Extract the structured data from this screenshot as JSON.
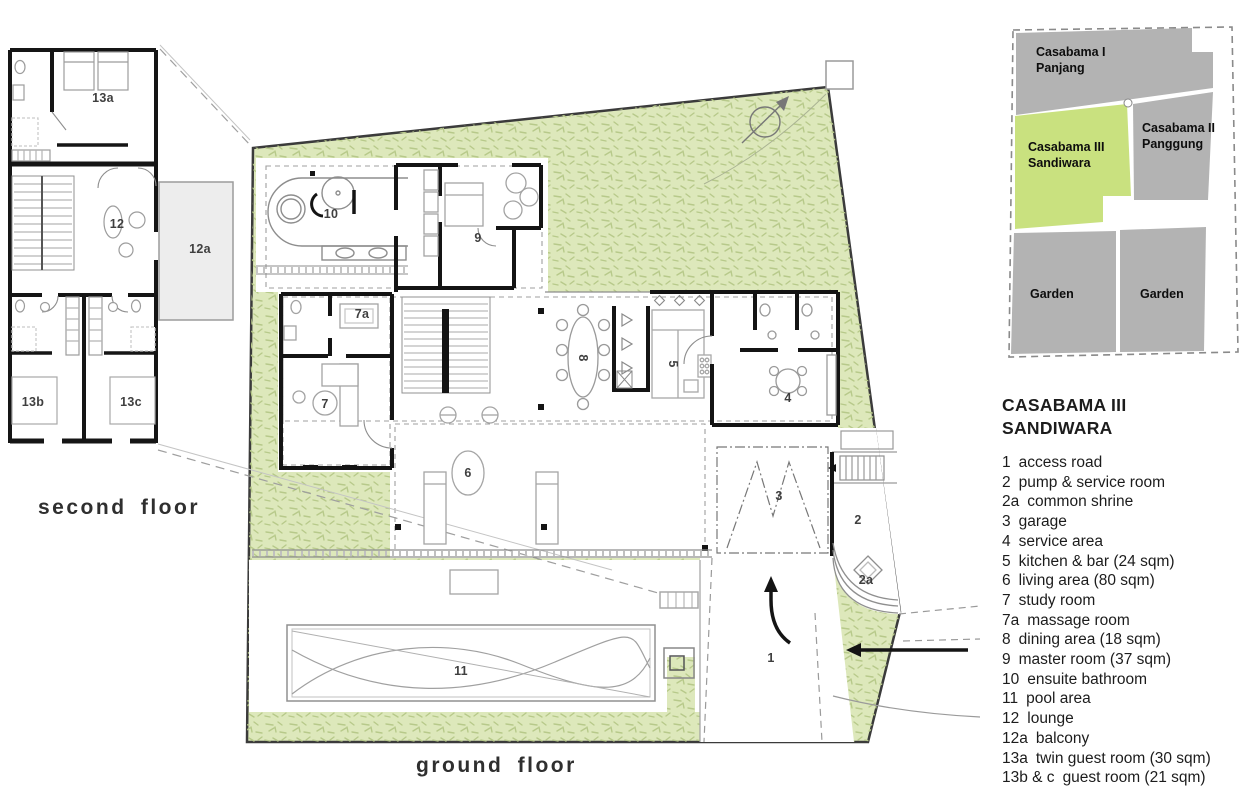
{
  "ground_floor": {
    "caption": "ground floor",
    "room_labels": [
      {
        "key": "10"
      },
      {
        "key": "9"
      },
      {
        "key": "7a"
      },
      {
        "key": "7"
      },
      {
        "key": "8"
      },
      {
        "key": "5"
      },
      {
        "key": "4"
      },
      {
        "key": "6"
      },
      {
        "key": "3"
      },
      {
        "key": "2"
      },
      {
        "key": "2a"
      },
      {
        "key": "1"
      },
      {
        "key": "11"
      }
    ]
  },
  "second_floor": {
    "caption": "second floor",
    "room_labels": [
      {
        "key": "13a"
      },
      {
        "key": "12"
      },
      {
        "key": "12a"
      },
      {
        "key": "13b"
      },
      {
        "key": "13c"
      }
    ]
  },
  "site_map": {
    "blocks": [
      {
        "name": "casabama-1",
        "line1": "Casabama I",
        "line2": "Panjang"
      },
      {
        "name": "casabama-3",
        "line1": "Casabama III",
        "line2": "Sandiwara",
        "highlight": true
      },
      {
        "name": "casabama-2",
        "line1": "Casabama II",
        "line2": "Panggung"
      },
      {
        "name": "garden-left",
        "line1": "Garden"
      },
      {
        "name": "garden-right",
        "line1": "Garden"
      }
    ]
  },
  "legend": {
    "title_line1": "CASABAMA III",
    "title_line2": "SANDIWARA",
    "items": [
      {
        "key": "1",
        "label": "access road"
      },
      {
        "key": "2",
        "label": "pump & service room"
      },
      {
        "key": "2a",
        "label": "common shrine"
      },
      {
        "key": "3",
        "label": "garage"
      },
      {
        "key": "4",
        "label": "service area"
      },
      {
        "key": "5",
        "label": "kitchen & bar (24 sqm)"
      },
      {
        "key": "6",
        "label": "living area (80 sqm)"
      },
      {
        "key": "7",
        "label": "study room"
      },
      {
        "key": "7a",
        "label": "massage room"
      },
      {
        "key": "8",
        "label": "dining area (18 sqm)"
      },
      {
        "key": "9",
        "label": "master room (37 sqm)"
      },
      {
        "key": "10",
        "label": "ensuite bathroom"
      },
      {
        "key": "11",
        "label": "pool area"
      },
      {
        "key": "12",
        "label": "lounge"
      },
      {
        "key": "12a",
        "label": "balcony"
      },
      {
        "key": "13a",
        "label": "twin guest room (30 sqm)"
      },
      {
        "key": "13b & c",
        "label": "guest room (21 sqm)"
      }
    ]
  },
  "colors": {
    "plan_green": "#dde8bb",
    "plan_green_dash": "#b7c98a",
    "map_green": "#c9e17f",
    "map_gray": "#b3b3b3",
    "wall": "#141414",
    "line_gray": "#8d8d8d"
  }
}
